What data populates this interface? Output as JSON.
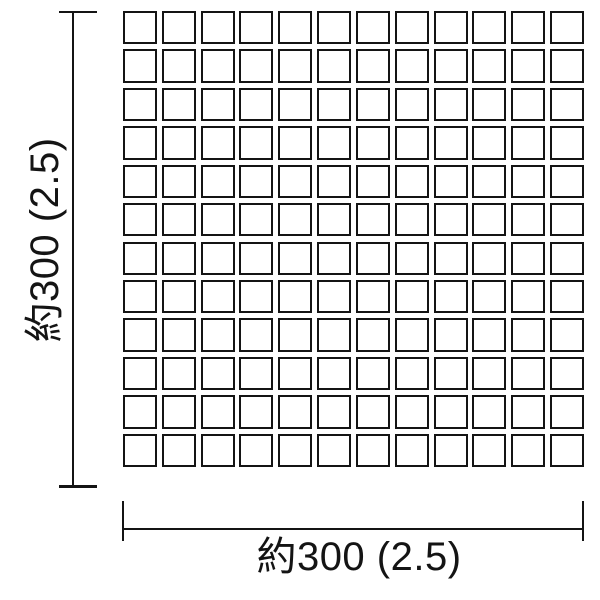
{
  "page": {
    "background": "#ffffff",
    "ink": "#141414"
  },
  "drawing": {
    "type": "tile-sheet-dimension-diagram",
    "grid": {
      "rows": 12,
      "cols": 12,
      "tile_shape": "square",
      "tile_fill": "#ffffff",
      "tile_border": "#141414"
    },
    "dimensions": {
      "vertical": {
        "label": "約300 (2.5)"
      },
      "horizontal": {
        "label": "約300 (2.5)"
      }
    }
  }
}
